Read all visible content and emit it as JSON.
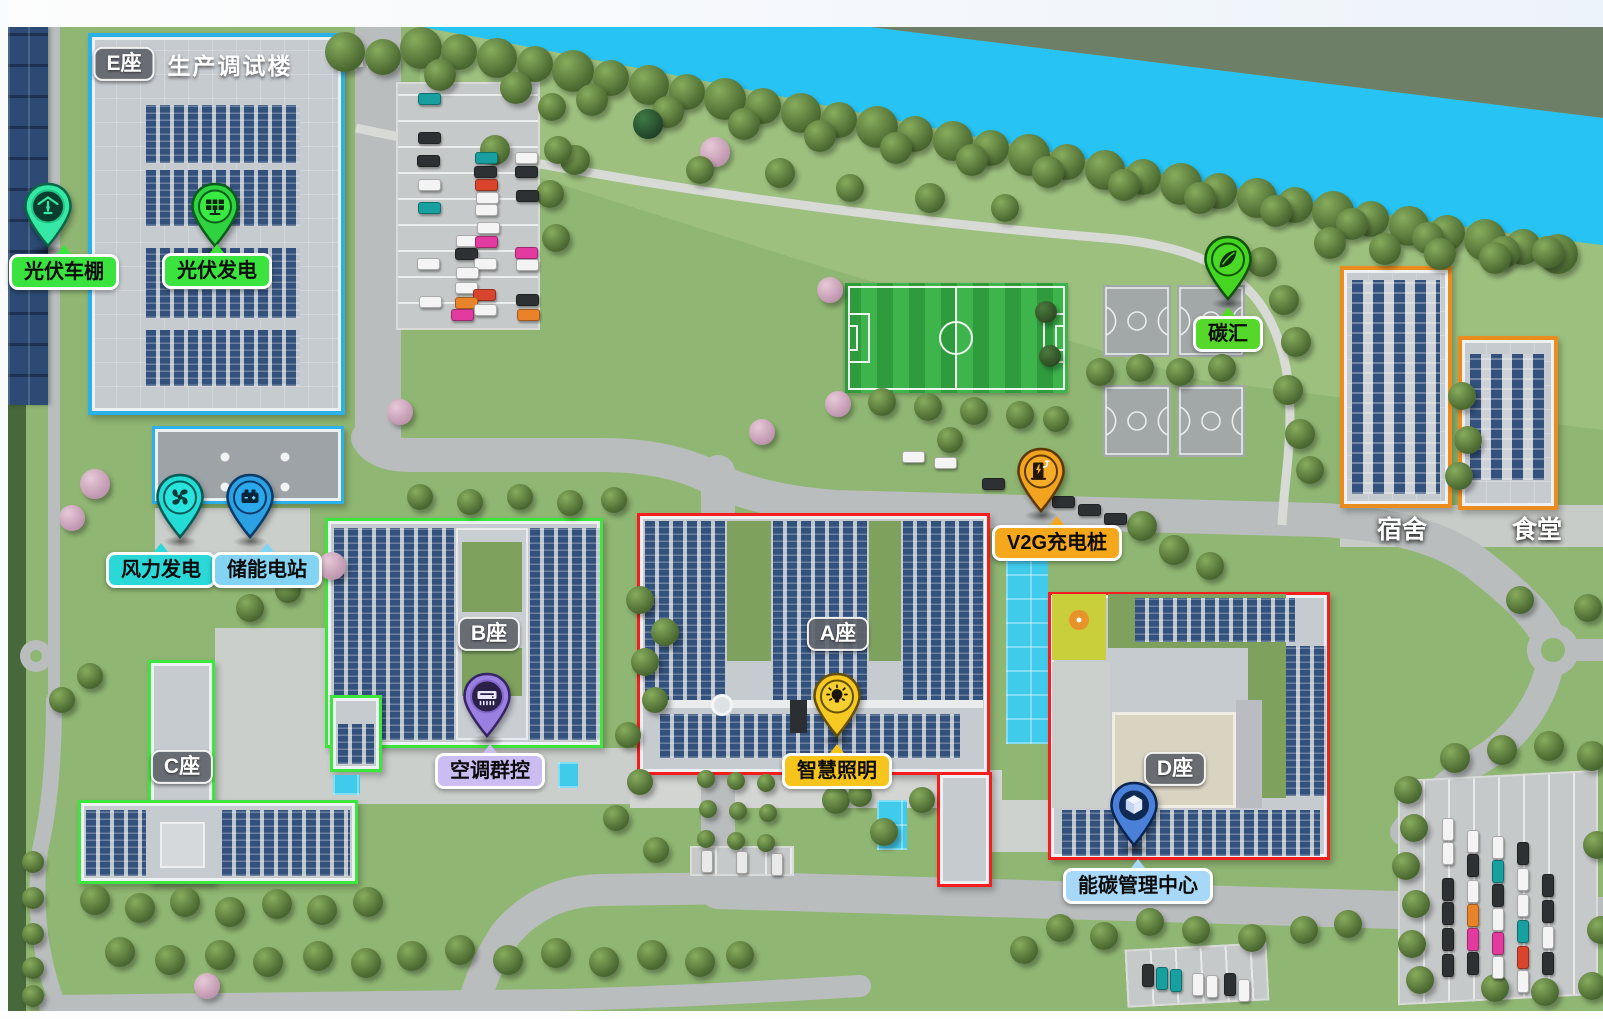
{
  "colors": {
    "river": "#26c3f4",
    "far_bank": "#6d7f66",
    "grass": "#90b673",
    "road": "#b9bdbd",
    "outline_building_e": "#2bb1ea",
    "outline_building_b_c": "#3ce63c",
    "outline_building_a_d": "#f51d1d",
    "outline_dorm_canteen": "#ea8c1e"
  },
  "building_badges": {
    "e": "E座",
    "a": "A座",
    "b": "B座",
    "c": "C座",
    "d": "D座"
  },
  "building_e_title": "生产调试楼",
  "area_labels": {
    "dormitory": "宿舍",
    "canteen": "食堂"
  },
  "pins": [
    {
      "id": "pv-carport",
      "label": "光伏车棚",
      "icon": "carport-icon",
      "pin_color": "#35e8a5",
      "label_bg": "#3be33e"
    },
    {
      "id": "pv-generation",
      "label": "光伏发电",
      "icon": "solar-panel-icon",
      "pin_color": "#2fd23f",
      "label_bg": "#3be33e"
    },
    {
      "id": "wind-power",
      "label": "风力发电",
      "icon": "fan-icon",
      "pin_color": "#23dcd6",
      "label_bg": "#2ad8d8"
    },
    {
      "id": "energy-storage",
      "label": "储能电站",
      "icon": "battery-icon",
      "pin_color": "#2ba0e2",
      "label_bg": "#82d4f2"
    },
    {
      "id": "carbon-sink",
      "label": "碳汇",
      "icon": "leaf-icon",
      "pin_color": "#45d622",
      "label_bg": "#55d829"
    },
    {
      "id": "v2g-charging",
      "label": "V2G充电桩",
      "icon": "ev-charger-icon",
      "pin_color": "#f2a41f",
      "label_bg": "#f6a81c"
    },
    {
      "id": "hvac-group-control",
      "label": "空调群控",
      "icon": "air-conditioner-icon",
      "pin_color": "#9a80e0",
      "label_bg": "#cbbdf2"
    },
    {
      "id": "smart-lighting",
      "label": "智慧照明",
      "icon": "light-bulb-icon",
      "pin_color": "#f5c822",
      "label_bg": "#f6c41a"
    },
    {
      "id": "energy-carbon-center",
      "label": "能碳管理中心",
      "icon": "cube-icon",
      "pin_color": "#4a80d8",
      "label_bg": "#a8d8f8"
    }
  ]
}
